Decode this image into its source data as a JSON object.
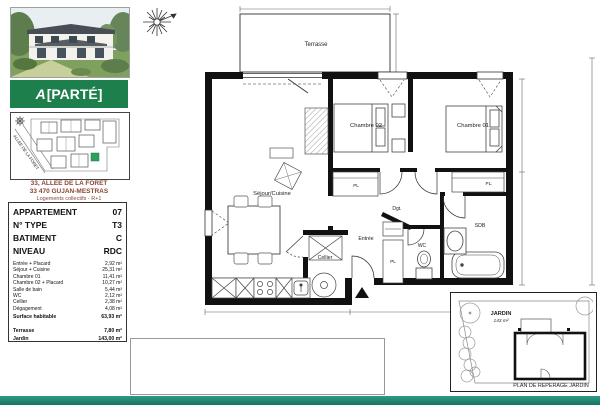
{
  "brand": {
    "logo_prefix": "A",
    "logo_rest": "[PARTÉ]",
    "banner_color": "#1d7f4c"
  },
  "site_plan": {
    "street_label": "ALLEE DE LA FORET",
    "highlight_color": "#2f9e5f"
  },
  "address": {
    "line1": "33, ALLEE DE LA FORET",
    "line2": "33 470 GUJAN-MESTRAS",
    "line3": "Logements collectifs - R+1"
  },
  "info_table": {
    "header_rows": [
      {
        "label": "APPARTEMENT",
        "value": "07"
      },
      {
        "label": "N° TYPE",
        "value": "T3"
      },
      {
        "label": "BATIMENT",
        "value": "C"
      },
      {
        "label": "NIVEAU",
        "value": "RDC"
      }
    ],
    "area_rows": [
      {
        "label": "Entrée + Placard",
        "value": "2,92 m²"
      },
      {
        "label": "Séjour + Cuisine",
        "value": "25,31 m²"
      },
      {
        "label": "Chambre 01",
        "value": "11,41 m²"
      },
      {
        "label": "Chambre 02 + Placard",
        "value": "10,27 m²"
      },
      {
        "label": "Salle de bain",
        "value": "5,44 m²"
      },
      {
        "label": "WC",
        "value": "2,12 m²"
      },
      {
        "label": "Cellier",
        "value": "2,38 m²"
      },
      {
        "label": "Dégagement",
        "value": "4,08 m²"
      }
    ],
    "total_row": {
      "label": "Surface habitable",
      "value": "63,93 m²"
    },
    "extra_rows": [
      {
        "label": "Terrasse",
        "value": "7,80 m²"
      },
      {
        "label": "Jardin",
        "value": "143,00 m²"
      }
    ]
  },
  "floor_plan": {
    "labels": {
      "terrasse": "Terrasse",
      "sejour": "Séjour/Cuisine",
      "chambre02": "Chambre 02",
      "chambre01": "Chambre 01",
      "dgt": "Dgt.",
      "entree": "Entrée",
      "wc": "WC",
      "sdb": "SDB",
      "cellier": "Cellier",
      "pl_chambre02": "PL",
      "pl_chambre01": "PL.",
      "pl_entree": "PL"
    }
  },
  "jardin_box": {
    "title": "JARDIN",
    "area": "143 m²",
    "caption": "PLAN DE REPERAGE JARDIN"
  }
}
